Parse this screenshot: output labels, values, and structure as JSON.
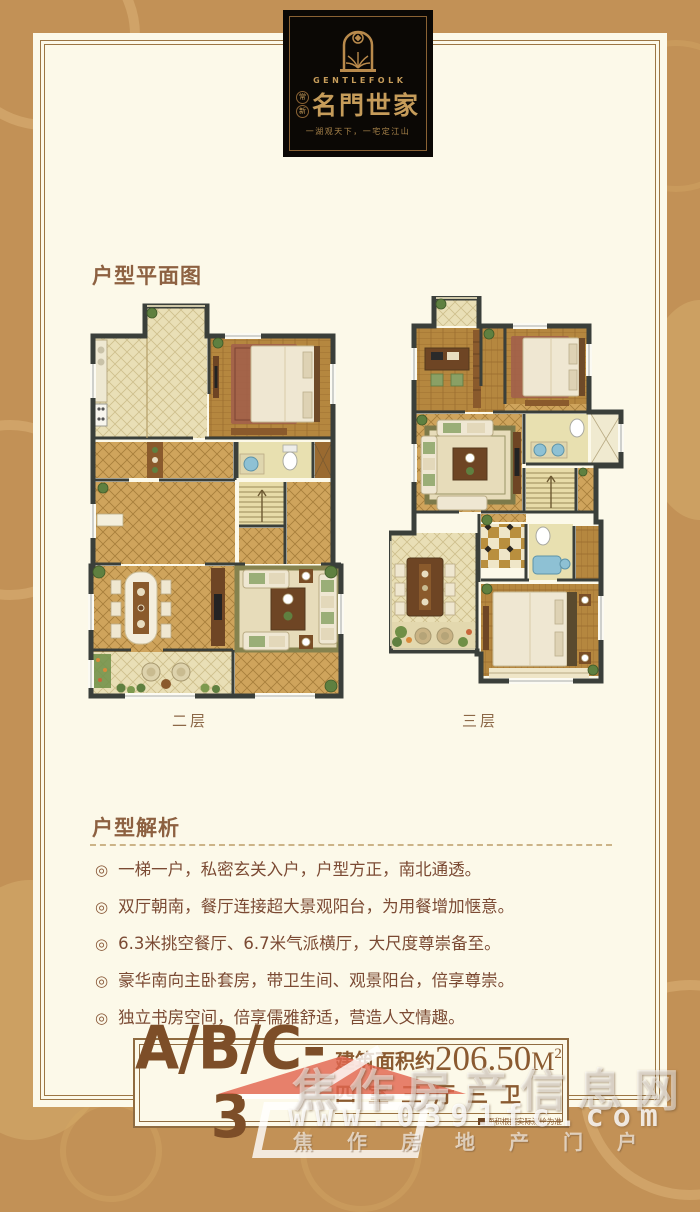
{
  "brand": {
    "seal_top": "常",
    "seal_bottom": "新",
    "name_en": "GENTLEFOLK",
    "name_cn": "名門世家",
    "tagline": "一湖观天下，一宅定江山"
  },
  "sections": {
    "floorplan_title": "户型平面图",
    "analysis_title": "户型解析"
  },
  "floorplans": [
    {
      "label": "二层"
    },
    {
      "label": "三层"
    }
  ],
  "ui": {
    "bullet_glyph": "◎"
  },
  "analysis_points": [
    "一梯一户，私密玄关入户，户型方正，南北通透。",
    "双厅朝南，餐厅连接超大景观阳台，为用餐增加惬意。",
    "6.3米挑空餐厅、6.7米气派横厅，大尺度尊崇备至。",
    "豪华南向主卧套房，带卫生间、观景阳台，倍享尊崇。",
    "独立书房空间，倍享儒雅舒适，营造人文情趣。"
  ],
  "unit_info": {
    "unit_code": "A/B/C-3",
    "area_label": "建筑面积约",
    "area_number": "206.50",
    "area_unit": "M",
    "area_sup": "2",
    "layout": "四室三厅三卫",
    "disclaimer": "面积根据实际测绘为准"
  },
  "watermark": {
    "site_name": "焦作房产信息网",
    "site_url": "www.0391fc.com",
    "site_slogan": "焦作房地产门户"
  },
  "colors": {
    "background": "#c29156",
    "card": "#fcf9e9",
    "brand_gold": "#c69c5a",
    "text_brown": "#7b4a33",
    "wall_dark": "#3a3f3a",
    "tile_gold": "#cfa45c",
    "watermark_red": "#e2654f"
  }
}
